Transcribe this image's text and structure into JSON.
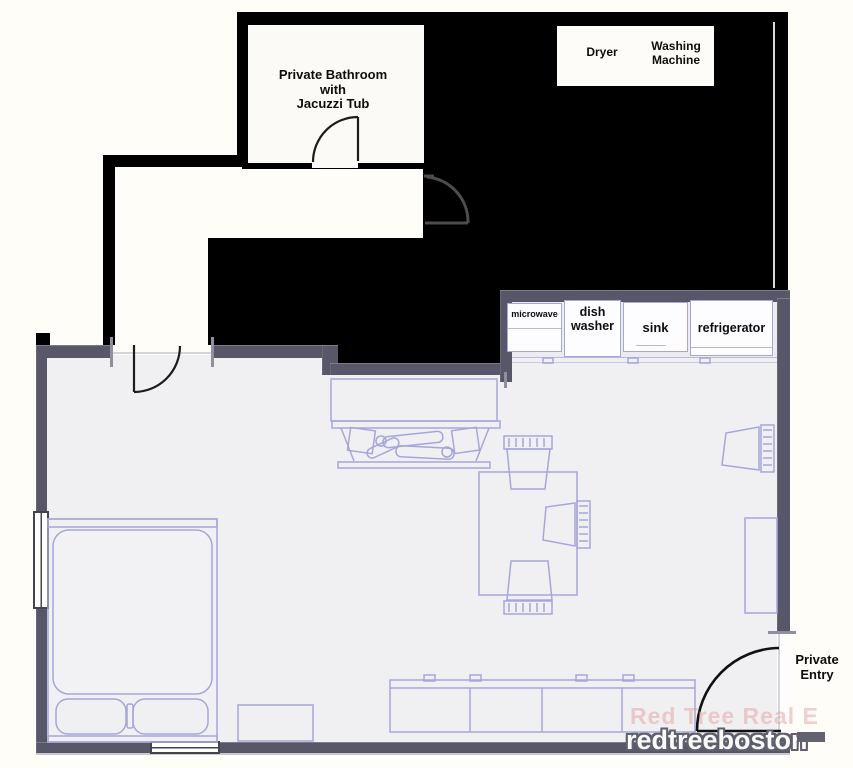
{
  "plan": {
    "bathroom": {
      "label": "Private Bathroom\nwith\nJacuzzi Tub"
    },
    "laundry": {
      "dryer": "Dryer",
      "washing_machine": "Washing\nMachine"
    },
    "kitchen": {
      "microwave": "microwave",
      "dishwasher": "dish\nwasher",
      "sink": "sink",
      "refrigerator": "refrigerator"
    },
    "entry": {
      "label": "Private\nEntry"
    }
  },
  "watermark": {
    "line1": "Red Tree Real E",
    "line2": "redtreeboston"
  },
  "colors": {
    "blackout": "#000000",
    "wall": "#575769",
    "floor": "#f0f0f2",
    "furniture_line": "#a6a6da",
    "label_text": "#0d0d0d"
  }
}
